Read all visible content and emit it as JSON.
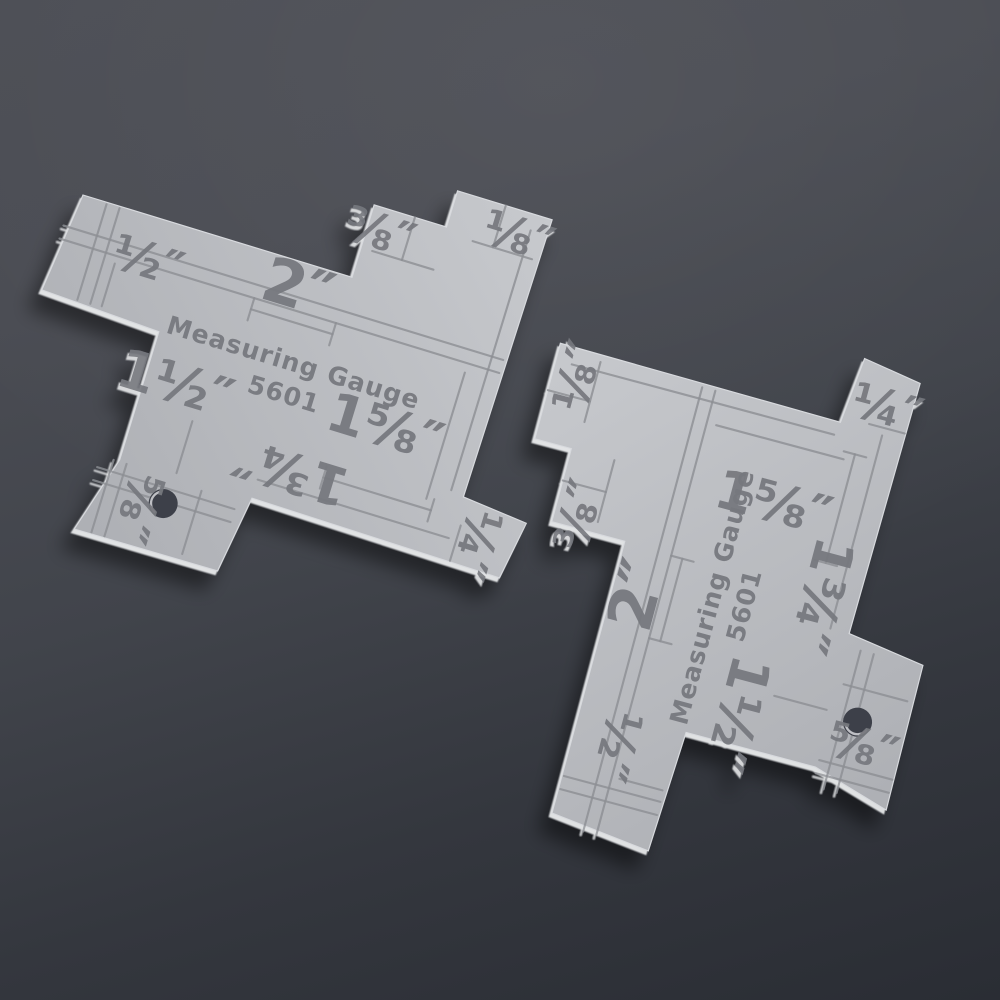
{
  "photo": {
    "gauge": {
      "title": "Measuring Gauge",
      "model": "5601",
      "labels": {
        "half": "½″",
        "two_inch": "2″",
        "three_eighths": "⅜″",
        "one_eighth": "⅛″",
        "one_and_a_half": "1½″",
        "one_and_five_eighths": "1⅝″",
        "one_and_three_quarters": "1¾″",
        "five_eighths": "⅝″",
        "one_quarter": "¼″"
      }
    },
    "colors": {
      "background_top": "#4c4e55",
      "background_bottom": "#2a2d34",
      "plate_light": "#c7c9cd",
      "plate_dark": "#abadb2",
      "etched_line": "#8d8f94",
      "label_ink": "#76787e",
      "hole_fill": "#3e414a",
      "bevel_highlight": "#f8f9fa"
    }
  }
}
